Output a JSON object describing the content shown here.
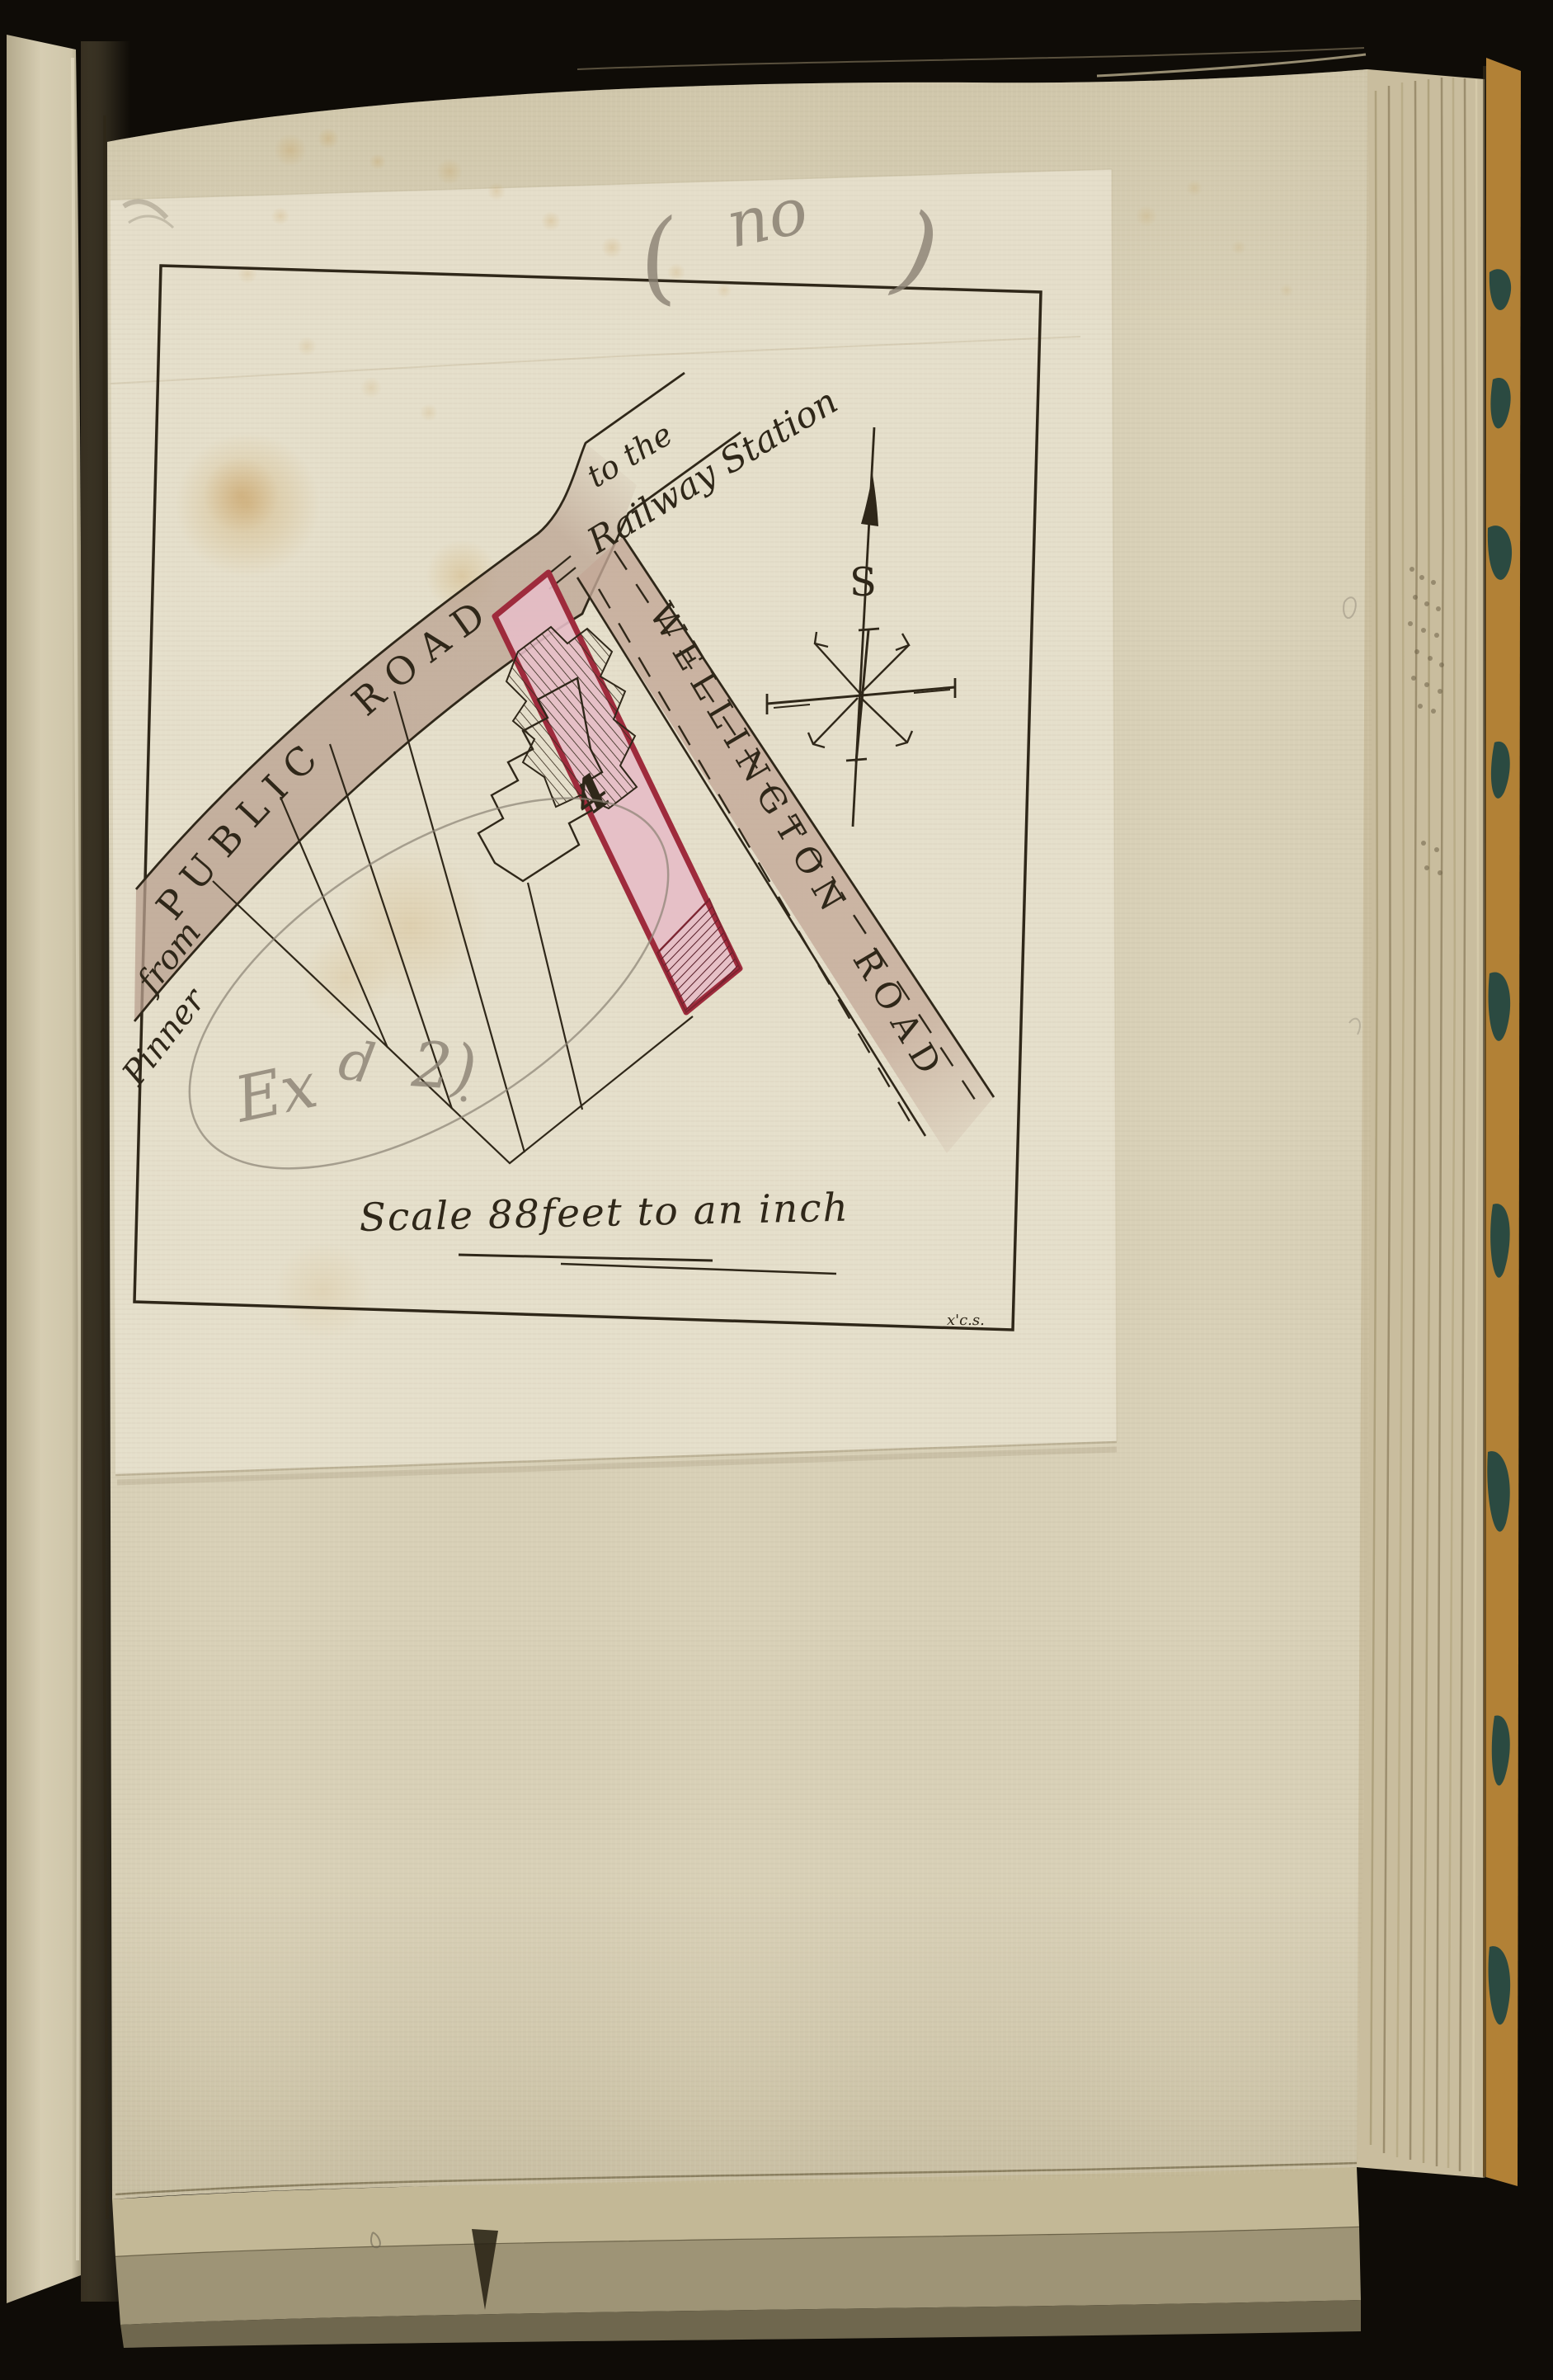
{
  "pencil": {
    "open_paren": "(",
    "word": "no",
    "close_paren": ")",
    "scribble_1": "Ex",
    "scribble_2": "d",
    "scribble_3": "2)"
  },
  "map": {
    "public_road": {
      "label": "PUBLIC ROAD",
      "from_line1": "from",
      "from_line2": "Pinner",
      "to_line1": "to the",
      "to_line2": "Railway Station"
    },
    "wellington_road": {
      "label": "WELLINGTON ROAD"
    },
    "plot_number": "4",
    "compass_letter": "S",
    "scale_caption": "Scale 88feet to an inch",
    "corner_inscription": "x'c.s."
  },
  "colors": {
    "paper": "#d8d0b7",
    "map_sheet": "#e6e0cc",
    "road_tan": "#b9a08f",
    "plot_pink": "#e6bcc6",
    "plot_border": "#9e2b3c",
    "ink": "#2f2719",
    "pencil": "#8a8173",
    "cover_marble": "#b28136",
    "marble_swirl": "#1c4442"
  }
}
